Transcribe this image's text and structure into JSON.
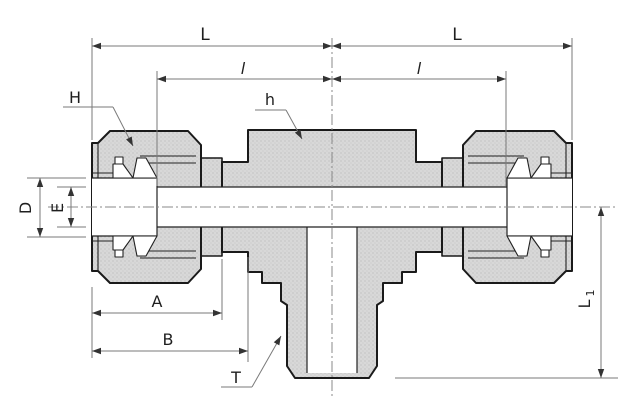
{
  "drawing": {
    "type": "engineering-dimension-drawing",
    "subject": "compression tube fitting - male branch tee, sectioned side view",
    "colors": {
      "background": "#ffffff",
      "part_fill": "#d8d8d8",
      "part_stipple": "#b9b9b9",
      "outline": "#1a1a1a",
      "internal_line": "#222222",
      "dimension_line": "#7a7a7a",
      "arrow": "#333333",
      "label": "#1f1f1f"
    },
    "labels": {
      "length_left": "L",
      "length_right": "L",
      "inset_left": "l",
      "inset_right": "l",
      "nut_flats": "H",
      "body_flats": "h",
      "hole_diameter": "D",
      "bore_diameter": "E",
      "dim_a": "A",
      "dim_b": "B",
      "thread": "T",
      "branch_length": "L",
      "branch_length_sub": "1"
    }
  }
}
